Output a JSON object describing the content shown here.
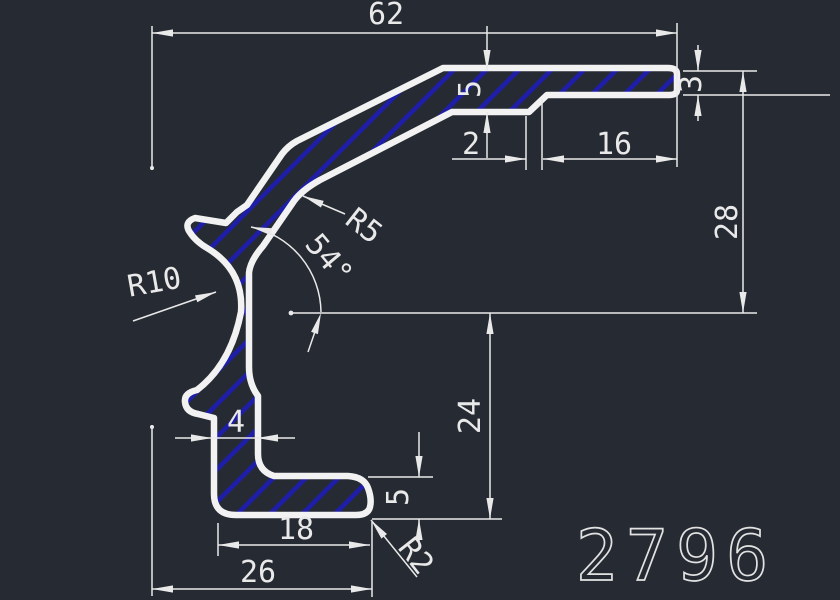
{
  "drawing": {
    "part_number": "2796",
    "dims": {
      "overall_width": "62",
      "top_thickness": "5",
      "step_width": "2",
      "top_right_length": "16",
      "end_thickness": "3",
      "right_height": "28",
      "mid_height": "24",
      "flange_thickness": "5",
      "leg_thickness": "4",
      "flange_inner_length": "18",
      "flange_overall_length": "26",
      "web_fillet": "R5",
      "groove_radius": "R10",
      "corner_fillet": "R2",
      "web_angle": "54°"
    },
    "colors": {
      "background": "#262a32",
      "line": "#e9e9e9",
      "hatch": "#1e1ea8",
      "outline": "#f2f2f2"
    }
  }
}
